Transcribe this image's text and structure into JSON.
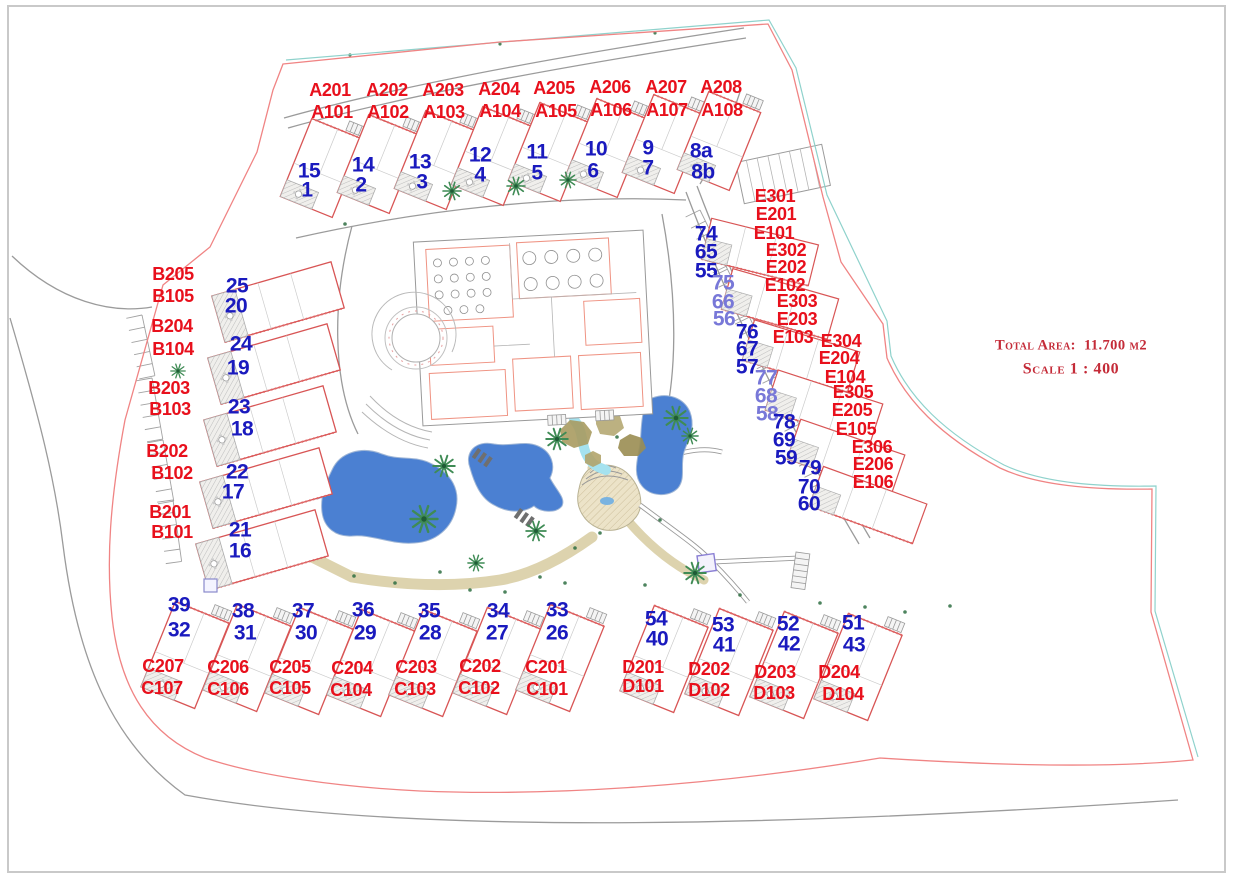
{
  "title_block": {
    "total_area_label": "Total Area:",
    "total_area_value": "11.700 м2",
    "scale_text": "Scale 1 : 400"
  },
  "colors": {
    "unit_label_red": "#e8101c",
    "plot_number_blue": "#1a1abe",
    "plot_number_violet": "#7878d8",
    "title_red": "#c42b38",
    "boundary_red": "#f08484",
    "boundary_teal": "#8fd2cc",
    "road_gray": "#9b9b9b",
    "building_outline_red": "#d85555",
    "pool_blue": "#4b80d2",
    "slide_cyan": "#a5e2ef",
    "rock_tan": "#a99b60",
    "palm_green": "#3f8b55",
    "walkway_beige": "#ece3c8"
  },
  "blocks": [
    {
      "block": "A",
      "buildings": [
        {
          "unit_labels": [
            {
              "t": "A201",
              "x": 330,
              "y": 90
            },
            {
              "t": "A101",
              "x": 332,
              "y": 112
            }
          ],
          "plot_numbers": [
            {
              "t": "15",
              "x": 309,
              "y": 171
            },
            {
              "t": "1",
              "x": 307,
              "y": 190
            }
          ]
        },
        {
          "unit_labels": [
            {
              "t": "A202",
              "x": 387,
              "y": 90
            },
            {
              "t": "A102",
              "x": 388,
              "y": 112
            }
          ],
          "plot_numbers": [
            {
              "t": "14",
              "x": 363,
              "y": 165
            },
            {
              "t": "2",
              "x": 361,
              "y": 185
            }
          ]
        },
        {
          "unit_labels": [
            {
              "t": "A203",
              "x": 443,
              "y": 90
            },
            {
              "t": "A103",
              "x": 444,
              "y": 112
            }
          ],
          "plot_numbers": [
            {
              "t": "13",
              "x": 420,
              "y": 162
            },
            {
              "t": "3",
              "x": 422,
              "y": 182
            }
          ]
        },
        {
          "unit_labels": [
            {
              "t": "A204",
              "x": 499,
              "y": 89
            },
            {
              "t": "A104",
              "x": 500,
              "y": 111
            }
          ],
          "plot_numbers": [
            {
              "t": "12",
              "x": 480,
              "y": 155
            },
            {
              "t": "4",
              "x": 480,
              "y": 175
            }
          ]
        },
        {
          "unit_labels": [
            {
              "t": "A205",
              "x": 554,
              "y": 88
            },
            {
              "t": "A105",
              "x": 556,
              "y": 111
            }
          ],
          "plot_numbers": [
            {
              "t": "11",
              "x": 537,
              "y": 152
            },
            {
              "t": "5",
              "x": 537,
              "y": 173
            }
          ]
        },
        {
          "unit_labels": [
            {
              "t": "A206",
              "x": 610,
              "y": 87
            },
            {
              "t": "A106",
              "x": 611,
              "y": 110
            }
          ],
          "plot_numbers": [
            {
              "t": "10",
              "x": 596,
              "y": 149
            },
            {
              "t": "6",
              "x": 593,
              "y": 171
            }
          ]
        },
        {
          "unit_labels": [
            {
              "t": "A207",
              "x": 666,
              "y": 87
            },
            {
              "t": "A107",
              "x": 667,
              "y": 110
            }
          ],
          "plot_numbers": [
            {
              "t": "9",
              "x": 648,
              "y": 148
            },
            {
              "t": "7",
              "x": 648,
              "y": 168
            }
          ]
        },
        {
          "unit_labels": [
            {
              "t": "A208",
              "x": 721,
              "y": 87
            },
            {
              "t": "A108",
              "x": 722,
              "y": 110
            }
          ],
          "plot_numbers": [
            {
              "t": "8a",
              "x": 701,
              "y": 151
            },
            {
              "t": "8b",
              "x": 703,
              "y": 172
            }
          ]
        }
      ]
    },
    {
      "block": "B",
      "buildings": [
        {
          "unit_labels": [
            {
              "t": "B205",
              "x": 173,
              "y": 274
            },
            {
              "t": "B105",
              "x": 173,
              "y": 296
            }
          ],
          "plot_numbers": [
            {
              "t": "25",
              "x": 237,
              "y": 286
            },
            {
              "t": "20",
              "x": 236,
              "y": 306
            }
          ]
        },
        {
          "unit_labels": [
            {
              "t": "B204",
              "x": 172,
              "y": 326
            },
            {
              "t": "B104",
              "x": 173,
              "y": 349
            }
          ],
          "plot_numbers": [
            {
              "t": "24",
              "x": 241,
              "y": 344
            },
            {
              "t": "19",
              "x": 238,
              "y": 368
            }
          ]
        },
        {
          "unit_labels": [
            {
              "t": "B203",
              "x": 169,
              "y": 388
            },
            {
              "t": "B103",
              "x": 170,
              "y": 409
            }
          ],
          "plot_numbers": [
            {
              "t": "23",
              "x": 239,
              "y": 407
            },
            {
              "t": "18",
              "x": 242,
              "y": 429
            }
          ]
        },
        {
          "unit_labels": [
            {
              "t": "B202",
              "x": 167,
              "y": 451
            },
            {
              "t": "B102",
              "x": 172,
              "y": 473
            }
          ],
          "plot_numbers": [
            {
              "t": "22",
              "x": 237,
              "y": 472
            },
            {
              "t": "17",
              "x": 233,
              "y": 492
            }
          ]
        },
        {
          "unit_labels": [
            {
              "t": "B201",
              "x": 170,
              "y": 512
            },
            {
              "t": "B101",
              "x": 172,
              "y": 532
            }
          ],
          "plot_numbers": [
            {
              "t": "21",
              "x": 240,
              "y": 530
            },
            {
              "t": "16",
              "x": 240,
              "y": 551
            }
          ]
        }
      ]
    },
    {
      "block": "C",
      "buildings": [
        {
          "unit_labels": [
            {
              "t": "C207",
              "x": 163,
              "y": 666
            },
            {
              "t": "C107",
              "x": 162,
              "y": 688
            }
          ],
          "plot_numbers": [
            {
              "t": "39",
              "x": 179,
              "y": 605
            },
            {
              "t": "32",
              "x": 179,
              "y": 630
            }
          ]
        },
        {
          "unit_labels": [
            {
              "t": "C206",
              "x": 228,
              "y": 667
            },
            {
              "t": "C106",
              "x": 228,
              "y": 689
            }
          ],
          "plot_numbers": [
            {
              "t": "38",
              "x": 243,
              "y": 611
            },
            {
              "t": "31",
              "x": 245,
              "y": 633
            }
          ]
        },
        {
          "unit_labels": [
            {
              "t": "C205",
              "x": 290,
              "y": 667
            },
            {
              "t": "C105",
              "x": 290,
              "y": 688
            }
          ],
          "plot_numbers": [
            {
              "t": "37",
              "x": 303,
              "y": 611
            },
            {
              "t": "30",
              "x": 306,
              "y": 633
            }
          ]
        },
        {
          "unit_labels": [
            {
              "t": "C204",
              "x": 352,
              "y": 668
            },
            {
              "t": "C104",
              "x": 351,
              "y": 690
            }
          ],
          "plot_numbers": [
            {
              "t": "36",
              "x": 363,
              "y": 610
            },
            {
              "t": "29",
              "x": 365,
              "y": 633
            }
          ]
        },
        {
          "unit_labels": [
            {
              "t": "C203",
              "x": 416,
              "y": 667
            },
            {
              "t": "C103",
              "x": 415,
              "y": 689
            }
          ],
          "plot_numbers": [
            {
              "t": "35",
              "x": 429,
              "y": 611
            },
            {
              "t": "28",
              "x": 430,
              "y": 633
            }
          ]
        },
        {
          "unit_labels": [
            {
              "t": "C202",
              "x": 480,
              "y": 666
            },
            {
              "t": "C102",
              "x": 479,
              "y": 688
            }
          ],
          "plot_numbers": [
            {
              "t": "34",
              "x": 498,
              "y": 611
            },
            {
              "t": "27",
              "x": 497,
              "y": 633
            }
          ]
        },
        {
          "unit_labels": [
            {
              "t": "C201",
              "x": 546,
              "y": 667
            },
            {
              "t": "C101",
              "x": 547,
              "y": 689
            }
          ],
          "plot_numbers": [
            {
              "t": "33",
              "x": 557,
              "y": 610
            },
            {
              "t": "26",
              "x": 557,
              "y": 633
            }
          ]
        }
      ]
    },
    {
      "block": "D",
      "buildings": [
        {
          "unit_labels": [
            {
              "t": "D201",
              "x": 643,
              "y": 667
            },
            {
              "t": "D101",
              "x": 643,
              "y": 686
            }
          ],
          "plot_numbers": [
            {
              "t": "54",
              "x": 656,
              "y": 619
            },
            {
              "t": "40",
              "x": 657,
              "y": 639
            }
          ]
        },
        {
          "unit_labels": [
            {
              "t": "D202",
              "x": 709,
              "y": 669
            },
            {
              "t": "D102",
              "x": 709,
              "y": 690
            }
          ],
          "plot_numbers": [
            {
              "t": "53",
              "x": 723,
              "y": 625
            },
            {
              "t": "41",
              "x": 724,
              "y": 645
            }
          ]
        },
        {
          "unit_labels": [
            {
              "t": "D203",
              "x": 775,
              "y": 672
            },
            {
              "t": "D103",
              "x": 774,
              "y": 693
            }
          ],
          "plot_numbers": [
            {
              "t": "52",
              "x": 788,
              "y": 624
            },
            {
              "t": "42",
              "x": 789,
              "y": 644
            }
          ]
        },
        {
          "unit_labels": [
            {
              "t": "D204",
              "x": 839,
              "y": 672
            },
            {
              "t": "D104",
              "x": 843,
              "y": 694
            }
          ],
          "plot_numbers": [
            {
              "t": "51",
              "x": 853,
              "y": 623
            },
            {
              "t": "43",
              "x": 854,
              "y": 645
            }
          ]
        }
      ]
    },
    {
      "block": "E",
      "buildings": [
        {
          "unit_labels": [
            {
              "t": "E301",
              "x": 775,
              "y": 196
            },
            {
              "t": "E201",
              "x": 776,
              "y": 214
            },
            {
              "t": "E101",
              "x": 774,
              "y": 233
            }
          ],
          "plot_numbers": [
            {
              "t": "74",
              "x": 706,
              "y": 234
            },
            {
              "t": "65",
              "x": 706,
              "y": 252
            },
            {
              "t": "55",
              "x": 706,
              "y": 271
            }
          ]
        },
        {
          "unit_labels": [
            {
              "t": "E302",
              "x": 786,
              "y": 250
            },
            {
              "t": "E202",
              "x": 786,
              "y": 267
            },
            {
              "t": "E102",
              "x": 785,
              "y": 285
            }
          ],
          "plot_numbers": [
            {
              "t": "75",
              "x": 723,
              "y": 283,
              "v": "violet"
            },
            {
              "t": "66",
              "x": 723,
              "y": 302,
              "v": "violet"
            },
            {
              "t": "56",
              "x": 724,
              "y": 319,
              "v": "violet"
            }
          ]
        },
        {
          "unit_labels": [
            {
              "t": "E303",
              "x": 797,
              "y": 301
            },
            {
              "t": "E203",
              "x": 797,
              "y": 319
            },
            {
              "t": "E103",
              "x": 793,
              "y": 337
            }
          ],
          "plot_numbers": [
            {
              "t": "76",
              "x": 747,
              "y": 332
            },
            {
              "t": "67",
              "x": 747,
              "y": 349
            },
            {
              "t": "57",
              "x": 747,
              "y": 367
            }
          ]
        },
        {
          "unit_labels": [
            {
              "t": "E304",
              "x": 841,
              "y": 341
            },
            {
              "t": "E204",
              "x": 839,
              "y": 358
            },
            {
              "t": "E104",
              "x": 845,
              "y": 377
            }
          ],
          "plot_numbers": [
            {
              "t": "77",
              "x": 766,
              "y": 378,
              "v": "violet"
            },
            {
              "t": "68",
              "x": 766,
              "y": 396,
              "v": "violet"
            },
            {
              "t": "58",
              "x": 767,
              "y": 414,
              "v": "violet"
            }
          ]
        },
        {
          "unit_labels": [
            {
              "t": "E305",
              "x": 853,
              "y": 392
            },
            {
              "t": "E205",
              "x": 852,
              "y": 410
            },
            {
              "t": "E105",
              "x": 856,
              "y": 429
            }
          ],
          "plot_numbers": [
            {
              "t": "78",
              "x": 784,
              "y": 422
            },
            {
              "t": "69",
              "x": 784,
              "y": 440
            },
            {
              "t": "59",
              "x": 786,
              "y": 458
            }
          ]
        },
        {
          "unit_labels": [
            {
              "t": "E306",
              "x": 872,
              "y": 447
            },
            {
              "t": "E206",
              "x": 873,
              "y": 464
            },
            {
              "t": "E106",
              "x": 873,
              "y": 482
            }
          ],
          "plot_numbers": [
            {
              "t": "79",
              "x": 810,
              "y": 468
            },
            {
              "t": "70",
              "x": 809,
              "y": 487
            },
            {
              "t": "60",
              "x": 809,
              "y": 504
            }
          ]
        }
      ]
    }
  ]
}
